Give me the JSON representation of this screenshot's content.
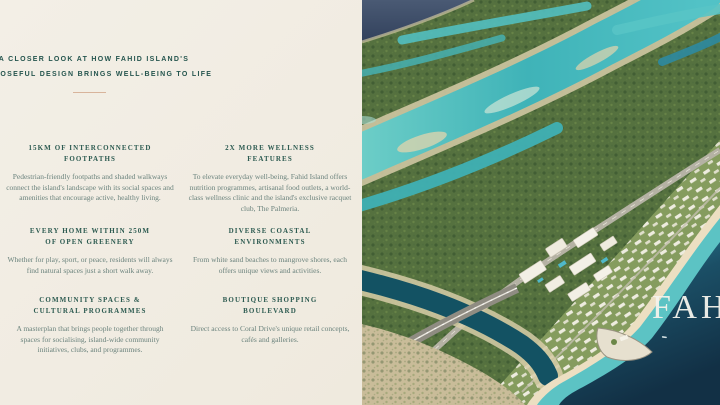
{
  "theme": {
    "panel_bg": "#f2eee5",
    "headline_color": "#25554e",
    "section_title_color": "#2d5b51",
    "body_text_color": "#6b837d",
    "divider_color": "#d8b49b",
    "sea_deep": "#16384e",
    "water_turquoise": "#5cc3c4",
    "mangrove_green": "#55713f"
  },
  "left_panel": {
    "headline": {
      "line1": "A CLOSER LOOK AT HOW FAHID ISLAND'S",
      "line2": "PURPOSEFUL DESIGN BRINGS WELL-BEING TO LIFE"
    },
    "sections": [
      {
        "title1": "15KM OF INTERCONNECTED",
        "title2": "FOOTPATHS",
        "body": "Pedestrian-friendly footpaths and shaded walkways connect the island's landscape with its social spaces and amenities that encourage active, healthy living."
      },
      {
        "title1": "2X MORE WELLNESS",
        "title2": "FEATURES",
        "body": "To elevate everyday well-being, Fahid Island offers nutrition programmes, artisanal food outlets, a world-class wellness clinic and the island's exclusive racquet club, The Palmeria."
      },
      {
        "title1": "EVERY HOME WITHIN 250M",
        "title2": "OF OPEN GREENERY",
        "body": "Whether for play, sport, or peace, residents will always find natural spaces just a short walk away."
      },
      {
        "title1": "DIVERSE COASTAL",
        "title2": "ENVIRONMENTS",
        "body": "From white sand beaches to mangrove shores, each offers unique views and activities."
      },
      {
        "title1": "COMMUNITY SPACES &",
        "title2": "CULTURAL PROGRAMMES",
        "body": "A masterplan that brings people together through spaces for socialising, island-wide community initiatives, clubs, and programmes."
      },
      {
        "title1": "BOUTIQUE SHOPPING",
        "title2": "BOULEVARD",
        "body": "Direct access to Coral Drive's unique retail concepts, cafés and galleries."
      }
    ]
  },
  "image_panel": {
    "overlay_text": "FAH"
  }
}
